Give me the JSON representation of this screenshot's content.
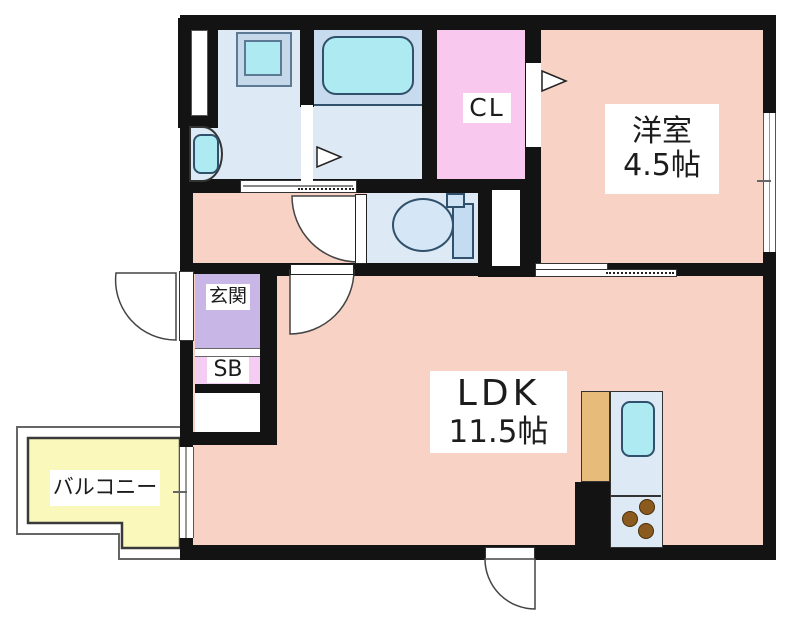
{
  "palette": {
    "wall": "#131313",
    "salmon": "#f8d3c5",
    "wet-blue": "#dde9f4",
    "tub-zone": "#c8dbee",
    "cyan": "#aeeaf2",
    "cl-pink": "#f9c8ee",
    "genkan-purple": "#c7b6e6",
    "sb-pink": "#f6cdf2",
    "balcony-yellow": "#fbf8bc",
    "kitchen-tan": "#e7bb79",
    "fixture-line": "#30506b",
    "burner": "#8a5a1f"
  },
  "rooms": {
    "yoshitsu": {
      "name": "洋室",
      "size": "4.5帖"
    },
    "ldk": {
      "name": "LDK",
      "size": "11.5帖"
    },
    "closet": {
      "label": "CL"
    },
    "genkan": {
      "label": "玄関"
    },
    "shoebox": {
      "label": "SB"
    },
    "balcony": {
      "label": "バルコニー"
    }
  },
  "icons": [
    "bathtub",
    "washing-machine-pan",
    "washbasin",
    "toilet",
    "kitchen-sink",
    "gas-stove-burners",
    "door-swing-arc",
    "door-direction-arrow",
    "sliding-door",
    "window"
  ]
}
